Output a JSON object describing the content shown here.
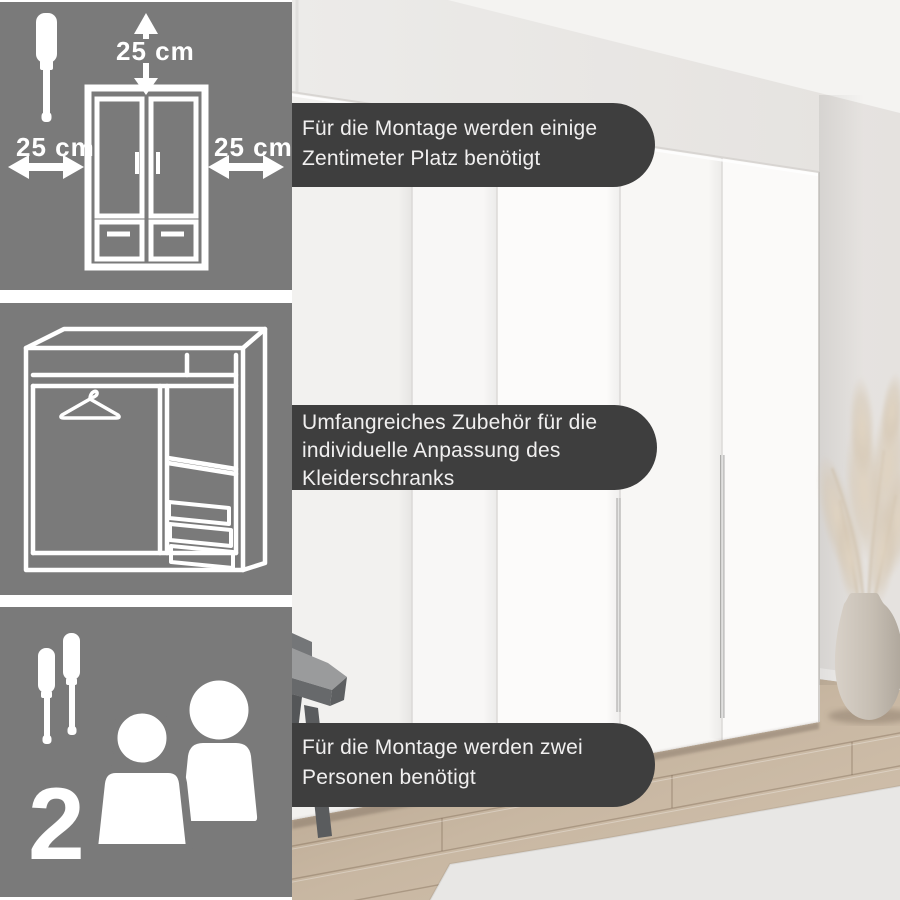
{
  "colors": {
    "panel_bg": "#7a7a7a",
    "banner_bg": "#3e3e3e",
    "banner_text": "#f0efef",
    "icon_white": "#ffffff",
    "wall": "#e9e7e5",
    "ceiling": "#f4f3f1",
    "wardrobe_white": "#faf9f8",
    "floor_wood": "#c3b19b",
    "rug": "#e8e7e5",
    "vase": "#c9c1b7",
    "pampas": "#dccfbd"
  },
  "info_panels": [
    {
      "id": "clearance",
      "icon": "wardrobe-clearance-diagram",
      "measurements": {
        "top": "25 cm",
        "left": "25 cm",
        "right": "25 cm"
      }
    },
    {
      "id": "interior",
      "icon": "wardrobe-interior-diagram"
    },
    {
      "id": "assembly",
      "icon": "two-persons-with-screwdrivers",
      "person_count": "2"
    }
  ],
  "banners": [
    {
      "id": "space",
      "lines": [
        "Für die Montage werden einige",
        "Zentimeter Platz benötigt"
      ]
    },
    {
      "id": "accessories",
      "lines": [
        "Umfangreiches Zubehör für die",
        "individuelle Anpassung des",
        "Kleiderschranks"
      ]
    },
    {
      "id": "two-persons",
      "lines": [
        "Für die Montage werden zwei",
        "Personen benötigt"
      ]
    }
  ]
}
